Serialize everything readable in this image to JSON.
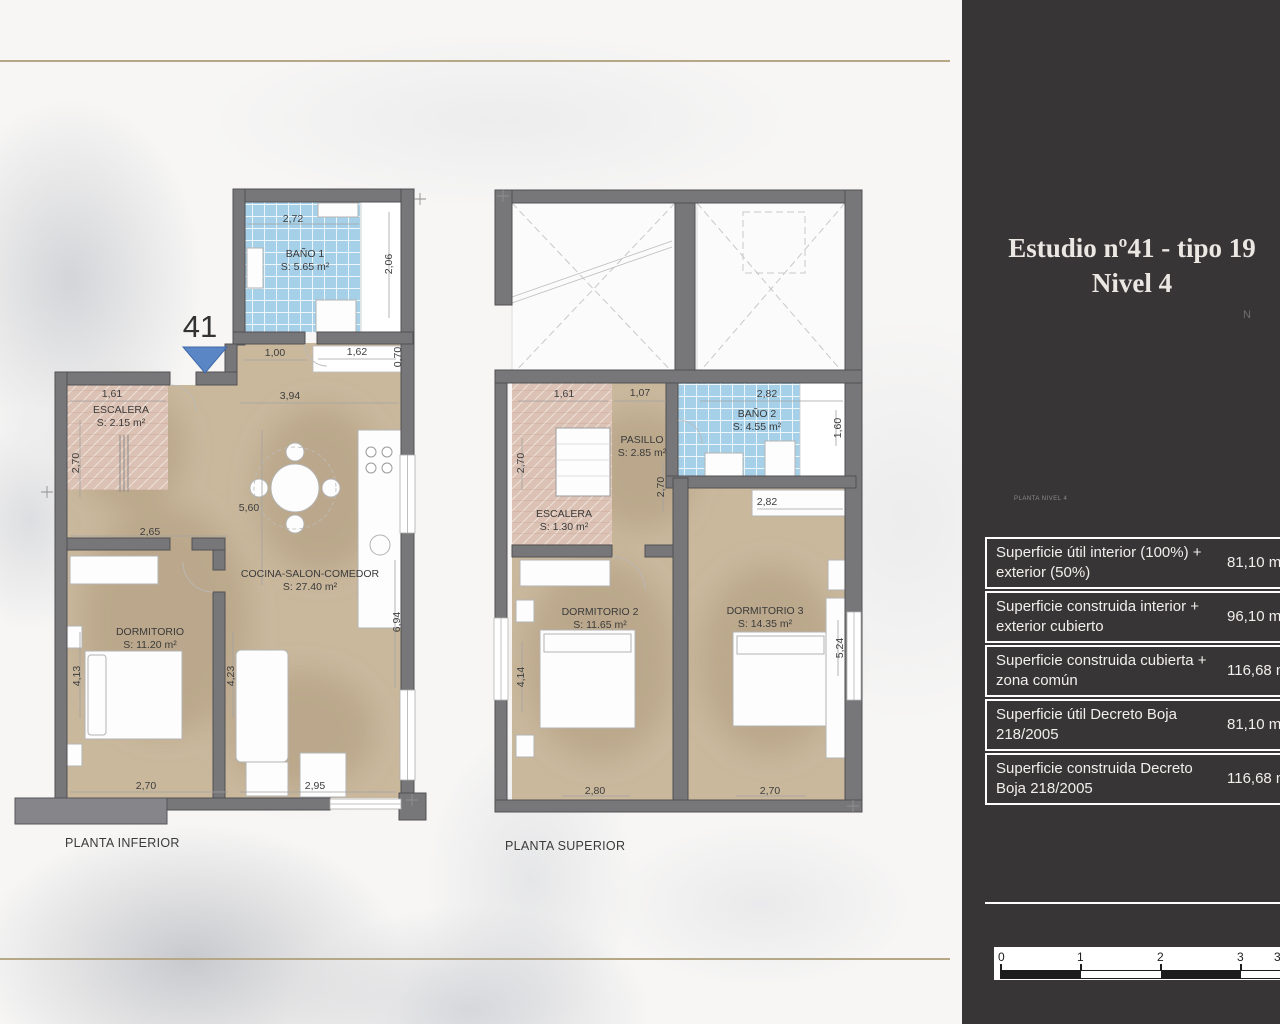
{
  "sidebar": {
    "title_line1": "Estudio nº41 - tipo 19",
    "title_line2": "Nivel 4",
    "compass_label": "N",
    "site_plan_caption": "PLANTA NIVEL 4",
    "table_rows": [
      {
        "label": "Superficie útil interior (100%) + exterior (50%)",
        "value": "81,10 m²"
      },
      {
        "label": "Superficie construida interior + exterior cubierto",
        "value": "96,10 m²"
      },
      {
        "label": "Superficie construida cubierta + zona común",
        "value": "116,68 m²"
      },
      {
        "label": "Superficie útil Decreto Boja 218/2005",
        "value": "81,10 m²"
      },
      {
        "label": "Superficie construida Decreto Boja 218/2005",
        "value": "116,68 m²"
      }
    ],
    "scale_labels": [
      "0",
      "1",
      "2",
      "3",
      "3,5"
    ]
  },
  "plans": {
    "inferior": {
      "caption": "PLANTA INFERIOR",
      "unit_marker": "41",
      "rooms": {
        "bano1": {
          "name": "BAÑO 1",
          "area": "S: 5.65 m²"
        },
        "escalera": {
          "name": "ESCALERA",
          "area": "S: 2.15 m²"
        },
        "cocina": {
          "name": "COCINA-SALON-COMEDOR",
          "area": "S: 27.40 m²"
        },
        "dormitorio": {
          "name": "DORMITORIO",
          "area": "S: 11.20 m²"
        }
      },
      "dims": [
        "2,72",
        "2,06",
        "1,00",
        "1,62",
        "0,70",
        "1,61",
        "3,94",
        "2,70",
        "5,60",
        "2,65",
        "6,94",
        "4,13",
        "4,23",
        "2,70",
        "2,95"
      ]
    },
    "superior": {
      "caption": "PLANTA SUPERIOR",
      "rooms": {
        "bano2": {
          "name": "BAÑO 2",
          "area": "S: 4.55 m²"
        },
        "pasillo": {
          "name": "PASILLO",
          "area": "S: 2.85 m²"
        },
        "escalera": {
          "name": "ESCALERA",
          "area": "S: 1.30 m²"
        },
        "dormitorio2": {
          "name": "DORMITORIO 2",
          "area": "S: 11.65 m²"
        },
        "dormitorio3": {
          "name": "DORMITORIO 3",
          "area": "S: 14.35 m²"
        }
      },
      "dims": [
        "1,61",
        "1,07",
        "2,82",
        "1,60",
        "2,70",
        "2,70",
        "2,82",
        "4,14",
        "2,80",
        "5,24",
        "2,70"
      ]
    }
  },
  "colors": {
    "accent_gold": "#b6a787",
    "sidebar_bg": "#383536",
    "bath_blue": "#a6d0e8",
    "floor_tan": "#cab89d",
    "stair_pink": "#dcc2b4",
    "wall_gray": "#77777a",
    "marker_blue": "#5a86c5",
    "highlight_red": "#c0504d"
  }
}
